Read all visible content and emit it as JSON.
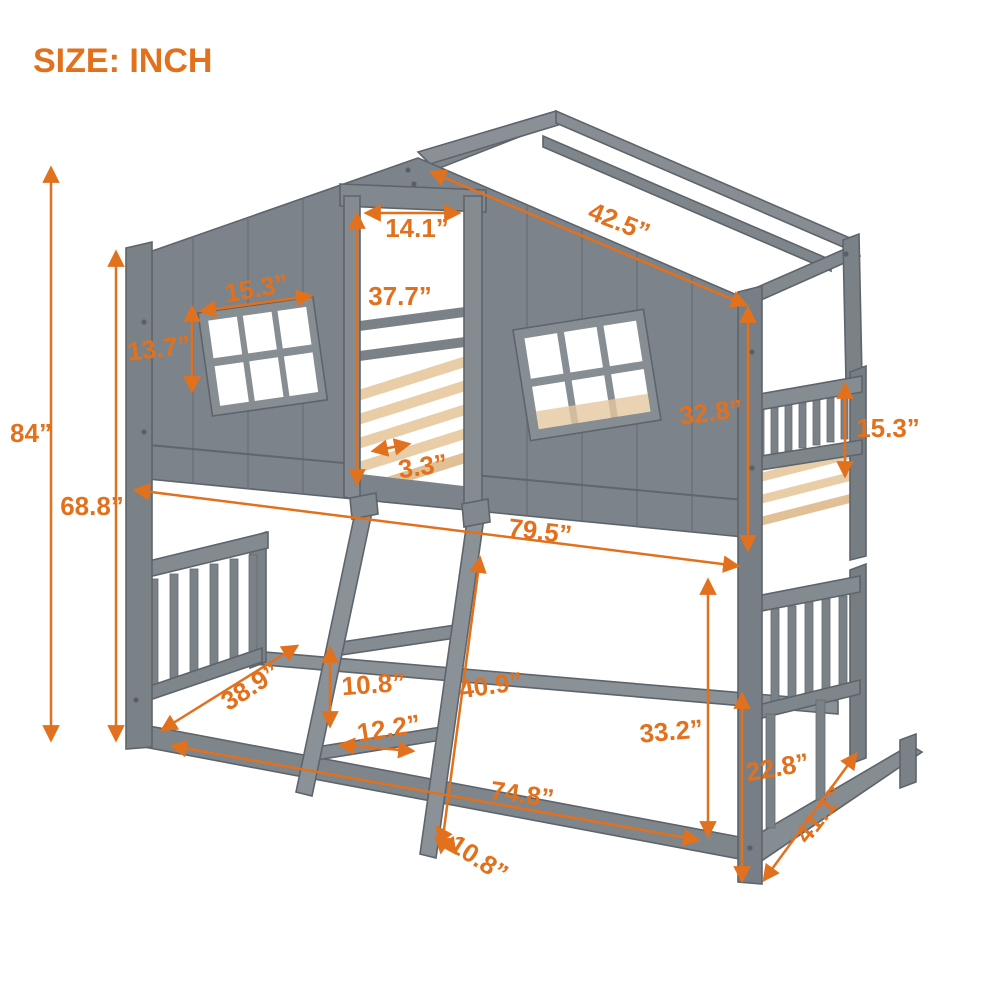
{
  "title": "SIZE: INCH",
  "accent_color": "#E2711E",
  "figure": {
    "type": "product-dimension-diagram",
    "product": "house-shaped bunk bed with roof frame, windows and ladder",
    "unit": "inch",
    "bed_color": "#7C838A",
    "slat_color": "#E9CDA7"
  },
  "dimensions": [
    {
      "name": "overall-height",
      "label": "84”",
      "x": 31,
      "y": 442,
      "rotate": 0
    },
    {
      "name": "height-to-eave",
      "label": "68.8”",
      "x": 92,
      "y": 515,
      "rotate": 0
    },
    {
      "name": "door-opening-width",
      "label": "14.1”",
      "x": 417,
      "y": 237,
      "rotate": 0
    },
    {
      "name": "door-opening-height",
      "label": "37.7”",
      "x": 400,
      "y": 305,
      "rotate": 0
    },
    {
      "name": "window-width",
      "label": "15.3”",
      "x": 258,
      "y": 297,
      "rotate": -10
    },
    {
      "name": "window-height",
      "label": "13.7”",
      "x": 160,
      "y": 357,
      "rotate": -7
    },
    {
      "name": "roof-slope-length",
      "label": "42.5”",
      "x": 616,
      "y": 230,
      "rotate": 22
    },
    {
      "name": "upper-wall-height",
      "label": "32.8”",
      "x": 712,
      "y": 421,
      "rotate": -7
    },
    {
      "name": "guardrail-height",
      "label": "15.3”",
      "x": 888,
      "y": 437,
      "rotate": 0
    },
    {
      "name": "slat-spacing",
      "label": "3.3”",
      "x": 424,
      "y": 475,
      "rotate": -8
    },
    {
      "name": "upper-bed-length",
      "label": "79.5”",
      "x": 539,
      "y": 540,
      "rotate": 7
    },
    {
      "name": "under-bed-clearance",
      "label": "33.2”",
      "x": 672,
      "y": 740,
      "rotate": -5
    },
    {
      "name": "lower-rail-height",
      "label": "22.8”",
      "x": 779,
      "y": 776,
      "rotate": -10
    },
    {
      "name": "lower-bed-width-right",
      "label": "41.1”",
      "x": 827,
      "y": 820,
      "rotate": -52
    },
    {
      "name": "lower-bed-length",
      "label": "74.8”",
      "x": 521,
      "y": 803,
      "rotate": 8
    },
    {
      "name": "lower-bed-width-left",
      "label": "38.9”",
      "x": 255,
      "y": 694,
      "rotate": -33
    },
    {
      "name": "ladder-step-spacing",
      "label": "10.8”",
      "x": 374,
      "y": 693,
      "rotate": -4
    },
    {
      "name": "ladder-length",
      "label": "40.9”",
      "x": 492,
      "y": 694,
      "rotate": -8
    },
    {
      "name": "ladder-step-width",
      "label": "12.2”",
      "x": 390,
      "y": 737,
      "rotate": -9
    },
    {
      "name": "ladder-foot-offset",
      "label": "10.8”",
      "x": 474,
      "y": 866,
      "rotate": 33
    }
  ]
}
